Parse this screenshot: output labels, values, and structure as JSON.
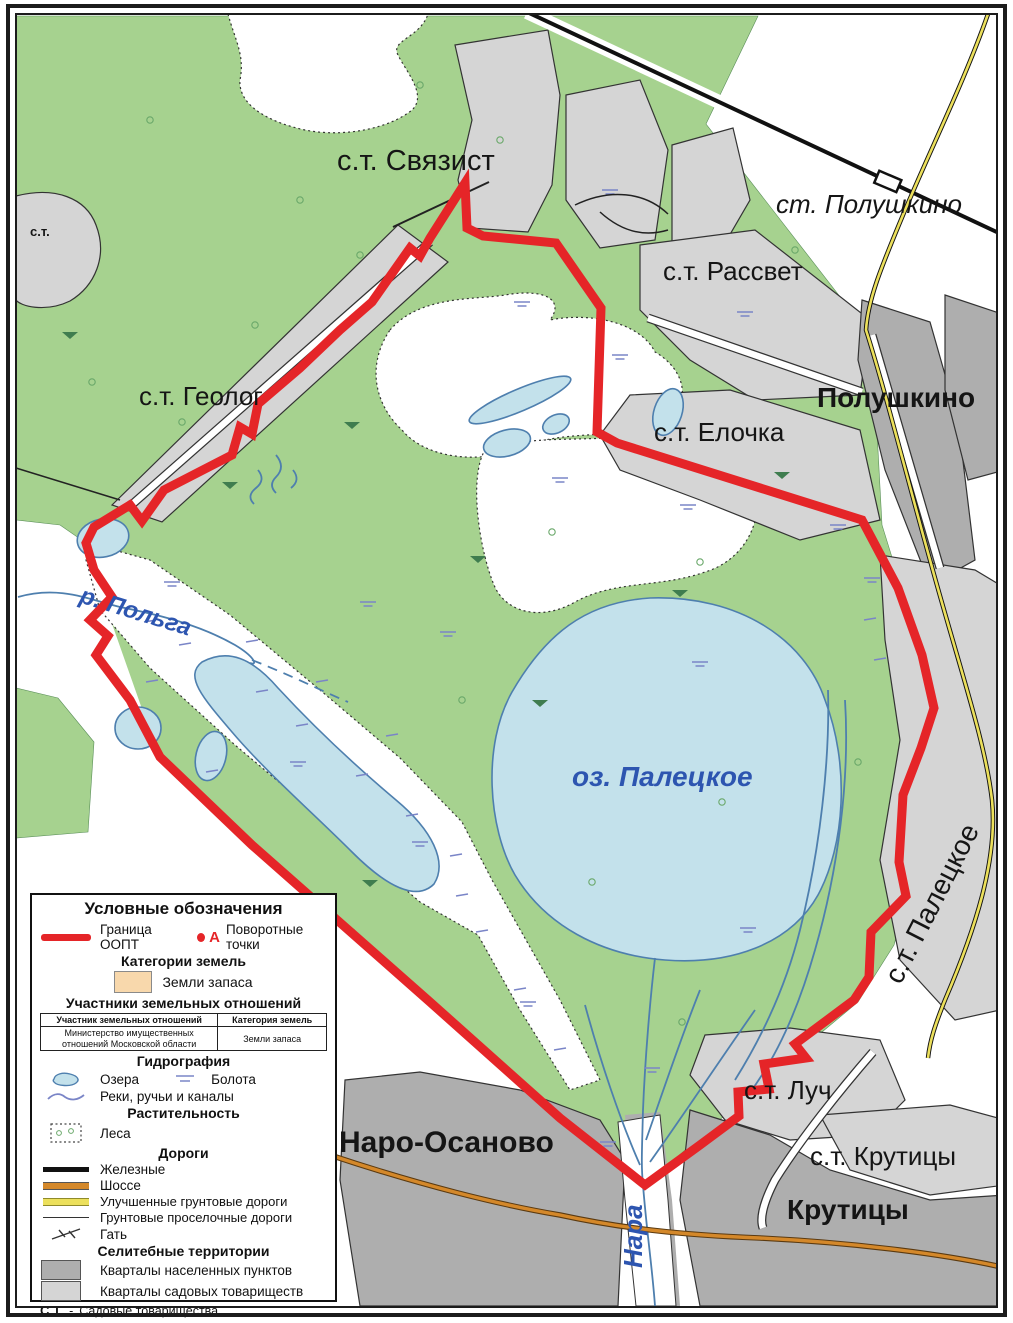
{
  "map": {
    "labels": {
      "svyazist": "с.т. Связист",
      "polushkino_station": "ст. Полушкино",
      "rassvet": "с.т. Рассвет",
      "polushkino_town": "Полушкино",
      "geolog": "с.т. Геолог",
      "yelochka": "с.т. Елочка",
      "polga_river": "р. Польга",
      "paletskoye_lake": "оз. Палецкое",
      "paletskoye_st": "с.т. Палецкое",
      "luch": "с.т. Луч",
      "krutitsy_st": "с.т. Крутицы",
      "krutitsy_town": "Крутицы",
      "naro_osanovo": "Наро-Осаново",
      "nara_river": "Нара",
      "st_small": "с.т."
    },
    "colors": {
      "forest_green": "#a6d28f",
      "settlement_light": "#d5d5d5",
      "settlement_dark": "#aeaeae",
      "water_fill": "#c3e1eb",
      "water_outline": "#4e7fae",
      "boundary_red": "#e52528",
      "highway_orange": "#d4882a",
      "road_yellow": "#ece05c",
      "river_label_blue": "#2d55b0",
      "zapas_peach": "#f8d8ac"
    }
  },
  "legend": {
    "title": "Условные обозначения",
    "boundary_label": "Граница ООПТ",
    "turning_point_letter": "А",
    "turning_points_label": "Поворотные точки",
    "categories_header": "Категории земель",
    "zemli_zapasa": "Земли запаса",
    "participants_header": "Участники земельных отношений",
    "table": {
      "col1_header": "Участник земельных отношений",
      "col2_header": "Категория земель",
      "row1_col1": "Министерство имущественных отношений Московской области",
      "row1_col2": "Земли запаса"
    },
    "hydrography_header": "Гидрография",
    "lakes_label": "Озера",
    "swamps_label": "Болота",
    "rivers_label": "Реки, ручьи и каналы",
    "vegetation_header": "Растительность",
    "forest_label": "Леса",
    "roads_header": "Дороги",
    "rail_label": "Железные",
    "highway_label": "Шоссе",
    "improved_dirt_label": "Улучшенные грунтовые дороги",
    "dirt_label": "Грунтовые проселочные дороги",
    "gat_label": "Гать",
    "settlement_header": "Селитебные территории",
    "town_blocks_label": "Кварталы населенных пунктов",
    "garden_blocks_label": "Кварталы садовых товариществ",
    "st_abbr": "С.Т.",
    "st_dash": "-",
    "st_abbr_label": "Садовые товарищества"
  }
}
